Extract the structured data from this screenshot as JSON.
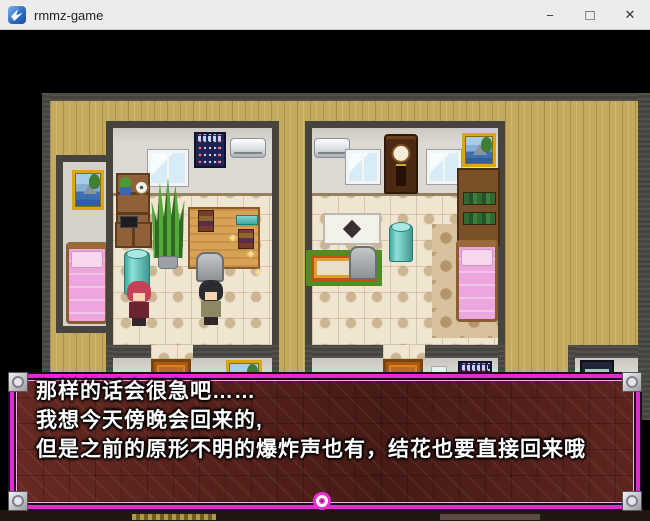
{
  "window": {
    "title": "rmmz-game",
    "minimize_glyph": "−",
    "maximize_glyph": "□",
    "close_glyph": "✕"
  },
  "dialog": {
    "lines": [
      "那样的话会很急吧……",
      "我想今天傍晚会回来的,",
      "但是之前的原形不明的爆炸声也有，结花也要直接回来哦"
    ]
  },
  "icons": {
    "sparkle": "✦"
  },
  "scene": {
    "location": "two-indoor-rooms-top-down",
    "objects": [
      "pink-bed",
      "painting",
      "window",
      "calendar",
      "air-conditioner",
      "bookshelf",
      "snake-plant",
      "water-drum",
      "tv-stand",
      "desk-platform",
      "rug",
      "chair",
      "table",
      "grandfather-clock",
      "door",
      "light-switch",
      "poster",
      "character-red-hair",
      "character-black-hair"
    ]
  },
  "colors": {
    "dialog_border": "#e829d3",
    "dialog_inner_line": "#ffa8f0",
    "dialog_bg": "#4f1e19",
    "floor_wood": "#c4aa5e",
    "wall_dark": "#45443f",
    "room_wall": "#dcd9d2",
    "tile_floor": "#efe5d1",
    "bed_pink": "#eda5de",
    "door_orange": "#c06a16",
    "accent_teal": "#3fa8a0",
    "titlebar_bg": "#ececec"
  }
}
